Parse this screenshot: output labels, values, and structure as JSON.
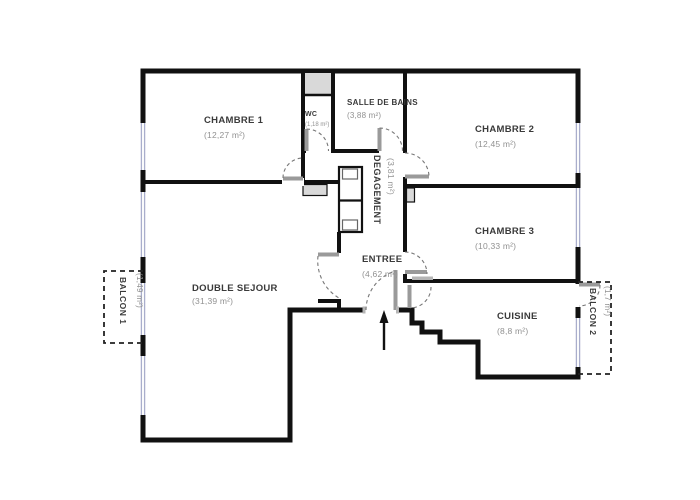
{
  "plan": {
    "title": "apartment-floor-plan",
    "rooms": {
      "chambre1": {
        "name": "CHAMBRE 1",
        "area": "(12,27 m²)"
      },
      "chambre2": {
        "name": "CHAMBRE 2",
        "area": "(12,45 m²)"
      },
      "chambre3": {
        "name": "CHAMBRE 3",
        "area": "(10,33 m²)"
      },
      "salle_de_bains": {
        "name": "SALLE DE BAINS",
        "area": "(3,88 m²)"
      },
      "wc": {
        "name": "WC",
        "area": "(1,18 m²)"
      },
      "degagement": {
        "name": "DEGAGEMENT",
        "area": "(3,81 m²)"
      },
      "entree": {
        "name": "ENTREE",
        "area": "(4,62 m²)"
      },
      "double_sejour": {
        "name": "DOUBLE SEJOUR",
        "area": "(31,39 m²)"
      },
      "cuisine": {
        "name": "CUISINE",
        "area": "(8,8 m²)"
      },
      "balcon1": {
        "name": "BALCON 1",
        "area": "(1,49 m²)"
      },
      "balcon2": {
        "name": "BALCON 2",
        "area": "(1,7 m²)"
      }
    },
    "colors": {
      "wall": "#111111",
      "window_glazing": "#a9aecc",
      "door_leaf": "#9a9a9a",
      "door_arc": "#777777",
      "duct_fill": "#d9d9d9",
      "room_name_text": "#3a3a3a",
      "area_text": "#919191",
      "background": "#ffffff"
    }
  }
}
